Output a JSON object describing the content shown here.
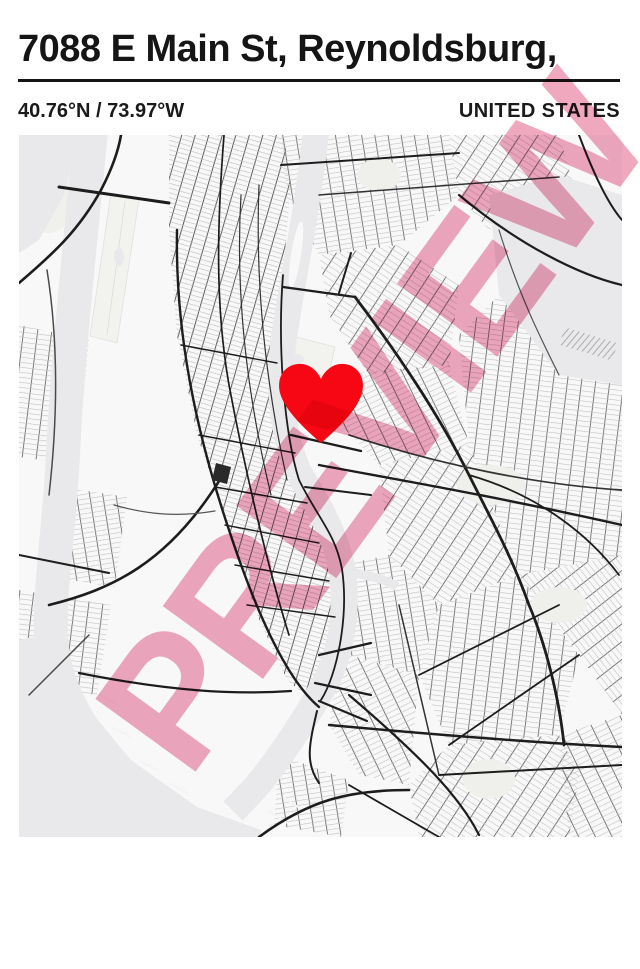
{
  "poster": {
    "title": "7088 E Main St, Reynoldsburg,",
    "coordinates": "40.76°N / 73.97°W",
    "country": "UNITED STATES",
    "watermark": "PREVIEW",
    "marker": {
      "shape": "heart",
      "x_percent": 50,
      "y_percent": 39
    },
    "colors": {
      "heart": "#f70613",
      "watermark_pink": "#ee9cb6",
      "water": "#e9e9eb",
      "land": "#f8f8f8",
      "road_dark": "#1d1d1d",
      "street_light": "#bcbcbc",
      "text": "#151515"
    }
  }
}
